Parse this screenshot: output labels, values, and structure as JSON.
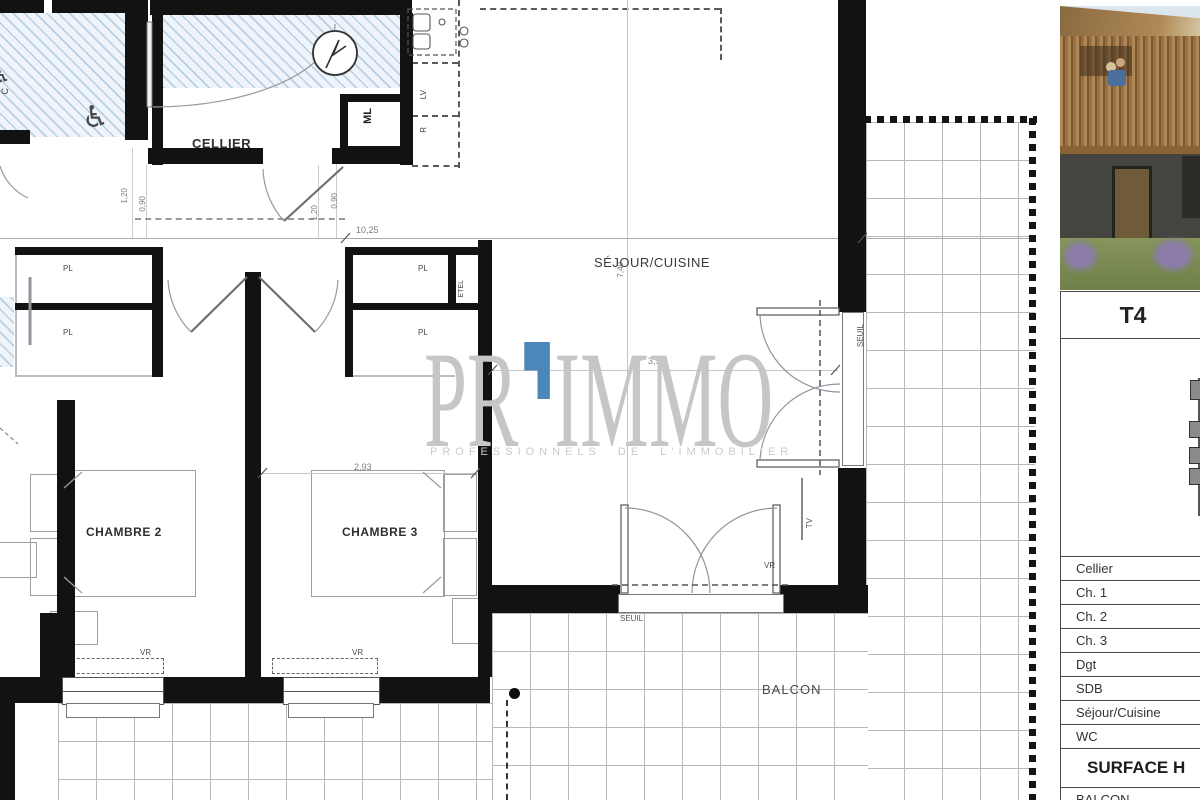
{
  "watermark": {
    "brand_left": "PR",
    "brand_right": "IMMO",
    "tagline": "PROFESSIONNELS DE L'IMMOBILIER",
    "accent_color": "#4d86b8"
  },
  "plan": {
    "rooms": {
      "cellier": "CELLIER",
      "sejour_cuisine": "SÉJOUR/CUISINE",
      "chambre2": "CHAMBRE 2",
      "chambre3": "CHAMBRE 3",
      "balcon": "BALCON"
    },
    "labels": {
      "ml": "ML",
      "lv": "LV",
      "r": "R",
      "pl": "PL",
      "etel": "ETEL",
      "vr": "VR",
      "tv": "TV",
      "seuil": "SEUIL",
      "wc_partial": "C"
    },
    "icons": {
      "wheelchair": "♿"
    },
    "dims": {
      "w_total": "10,25",
      "h_sejour": "7,40",
      "w_sejour": "3,92",
      "w_chambre3": "2,93",
      "d120": "1,20",
      "d090": "0,90"
    }
  },
  "sidebar": {
    "unit": "T4",
    "table": {
      "rows": [
        "Cellier",
        "Ch. 1",
        "Ch. 2",
        "Ch. 3",
        "Dgt",
        "SDB",
        "Séjour/Cuisine",
        "WC"
      ],
      "surface": "SURFACE H",
      "balcon": "BALCON"
    }
  }
}
